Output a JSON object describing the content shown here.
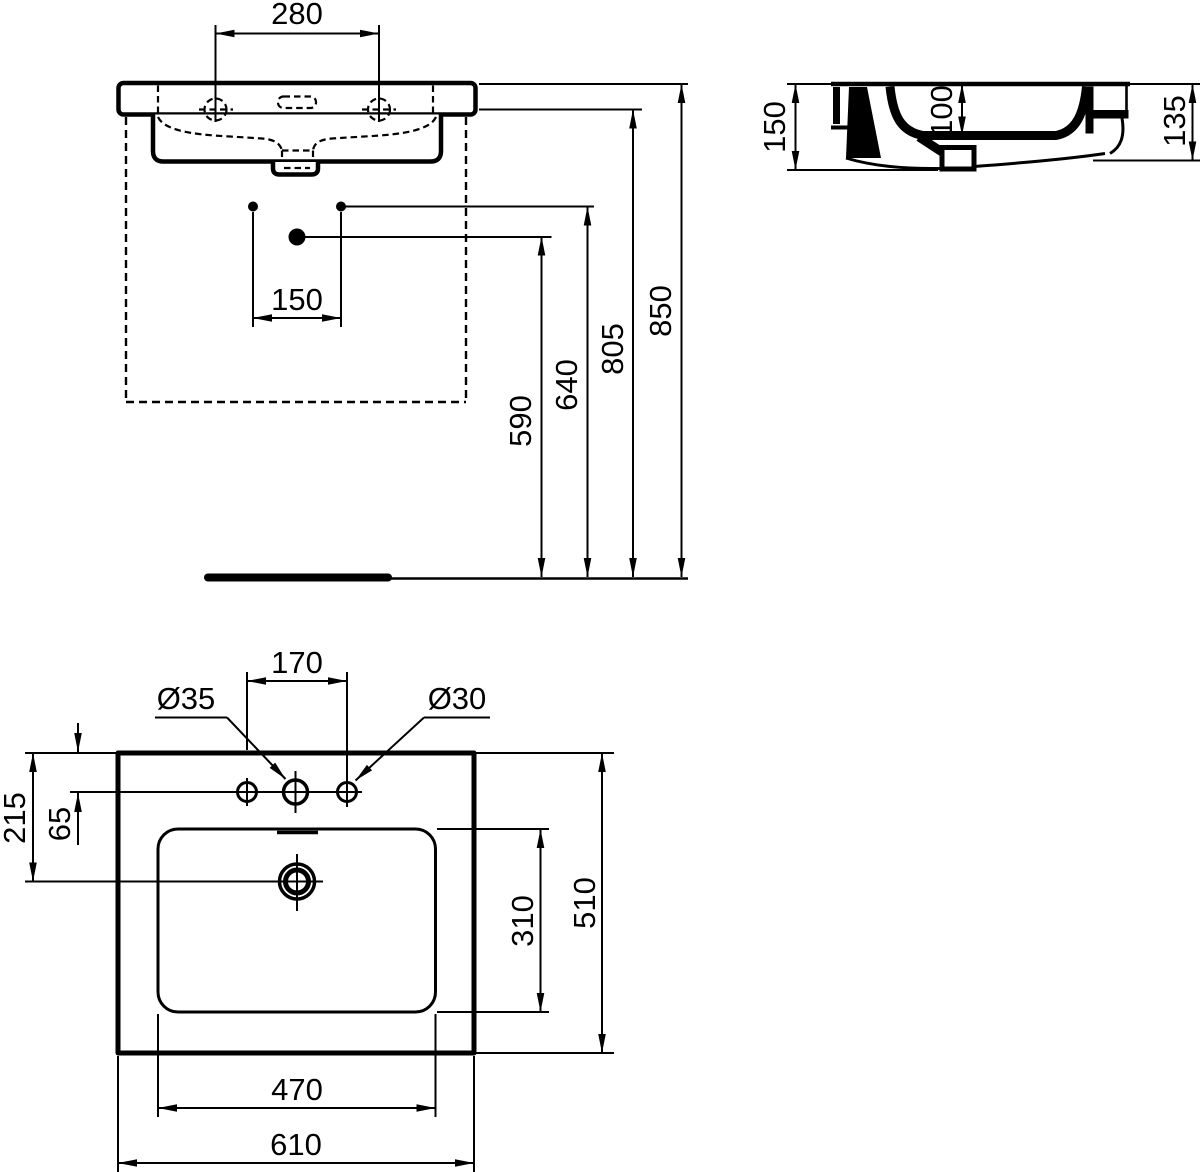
{
  "meta": {
    "background": "#ffffff",
    "ink_color": "#000000",
    "drawing_type": "washbasin dimensional technical drawing"
  },
  "views": {
    "front": {
      "label": "front-elevation",
      "dims": {
        "tap_centres": "280",
        "drain_offset": "150",
        "height_590": "590",
        "height_640": "640",
        "height_805": "805",
        "height_850": "850"
      }
    },
    "side": {
      "label": "side-section",
      "dims": {
        "depth_150": "150",
        "bowl_depth_100": "100",
        "front_height_135": "135"
      }
    },
    "plan": {
      "label": "plan-view",
      "dims": {
        "tap_spacing_170": "170",
        "tap_hole_dia_35": "Ø35",
        "tap_hole_dia_30": "Ø30",
        "drain_setback_215": "215",
        "deck_depth_65": "65",
        "bowl_depth_310": "310",
        "overall_depth_510": "510",
        "bowl_width_470": "470",
        "overall_width_610": "610"
      }
    }
  }
}
